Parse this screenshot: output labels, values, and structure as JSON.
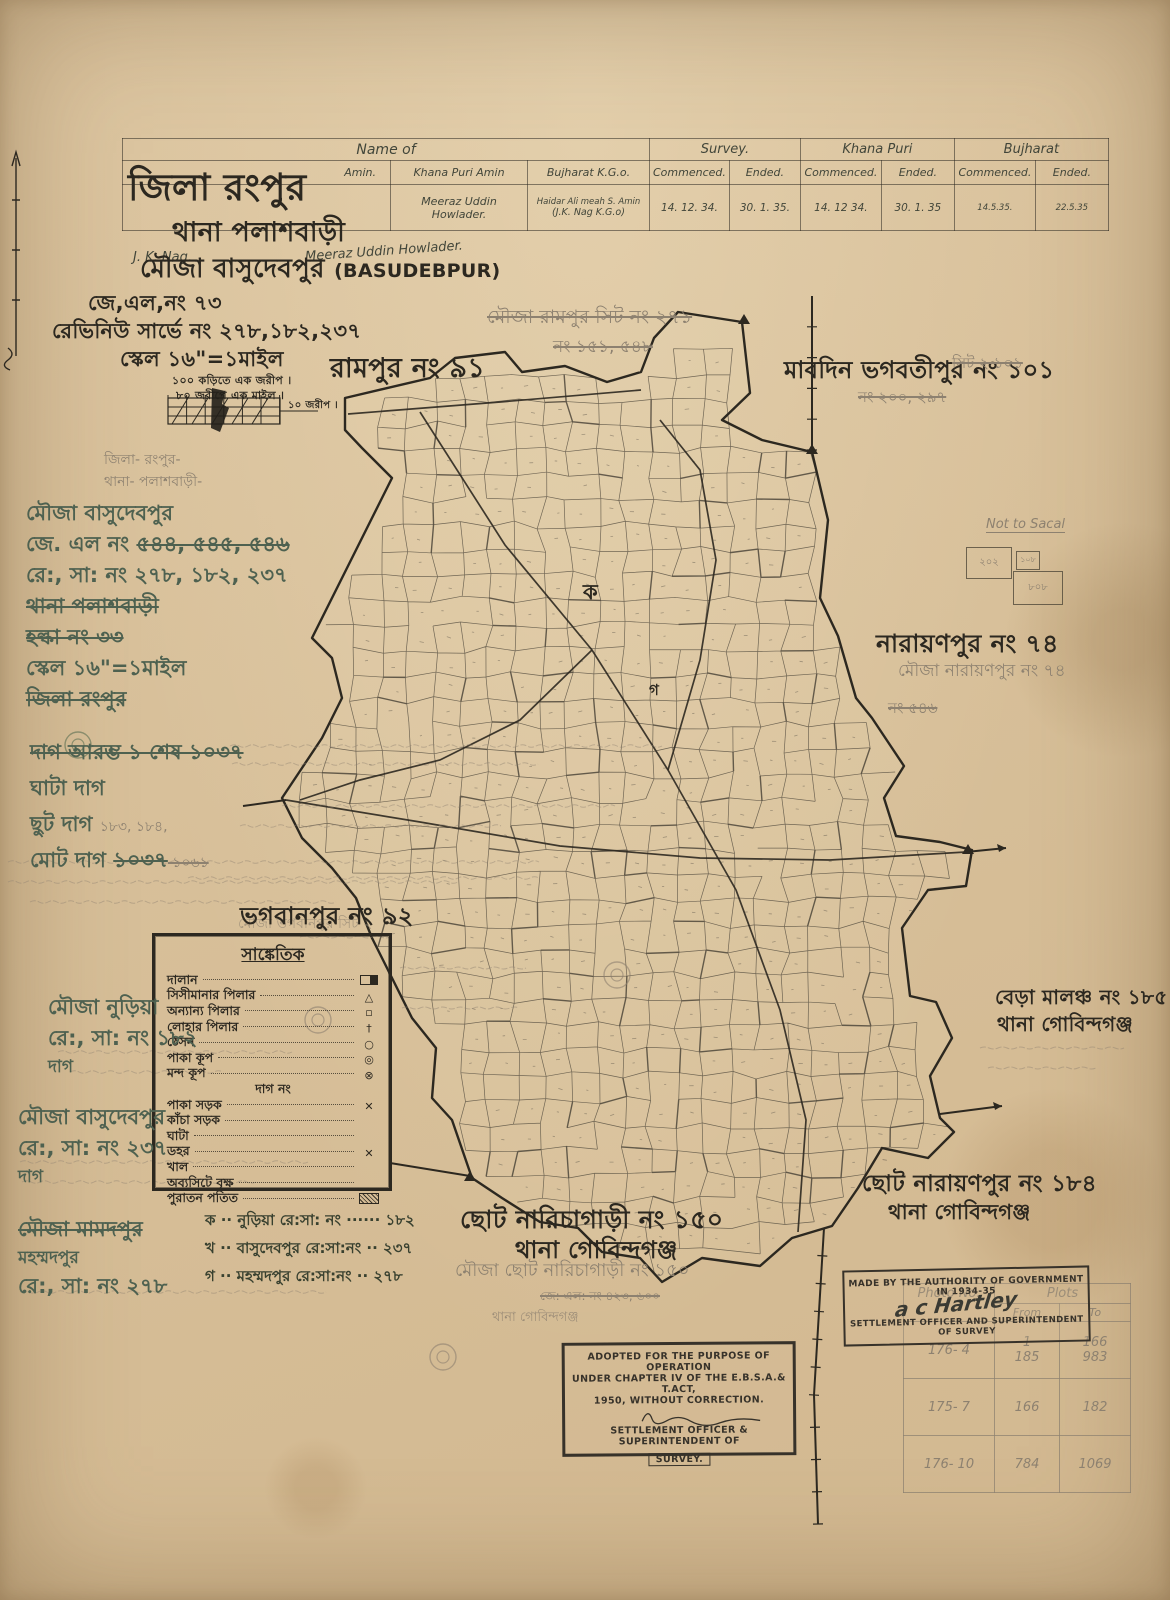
{
  "colors": {
    "paper": "#d8c09a",
    "ink": "#2c2820",
    "pencil": "#8d8170",
    "green": "#4e6150"
  },
  "title_block": {
    "district": "জিলা রংপুর",
    "thana": "থানা পলাশবাড়ী",
    "mouza": "মৌজা বাসুদেবপুর",
    "mouza_roman": "(BASUDEBPUR)",
    "jl_no": "জে,এল,নং ৭৩",
    "revenue_survey_no": "রেভিনিউ সার্ভে নং ২৭৮,১৮২,২৩৭",
    "scale": "স্কেল ১৬\"=১মাইল",
    "scale_note1": "১০০ কড়িতে এক জরীপ ।",
    "scale_note2": "৮০ জরীপে এক মাইল ।",
    "scale_bar_label": "১০ জরীপ ।"
  },
  "survey_table": {
    "name_of": "Name of",
    "amin": "Amin.",
    "khana_puri_amin": "Khana Puri Amin",
    "bujharat_kgo": "Bujharat K.G.o.",
    "survey": "Survey.",
    "khana_puri": "Khana Puri",
    "bujharat": "Bujharat",
    "commenced": "Commenced.",
    "ended": "Ended.",
    "row": {
      "jk_nag": "J. K. Nag.",
      "amin_name": "Meeraz Uddin Howlader.",
      "khana_puri_amin_name": "Meeraz Uddin Howlader.",
      "bujharat_1": "Haidar Ali meah  S. Amin",
      "bujharat_2": "(J.K. Nag  K.G.o)",
      "survey_c": "14. 12. 34.",
      "survey_e": "30. 1. 35.",
      "kp_c": "14. 12 34.",
      "kp_e": "30. 1. 35",
      "bj_c": "14.5.35.",
      "bj_e": "22.5.35"
    }
  },
  "neighbors": {
    "rampur": "রামপুর নং ৯১",
    "mabdin": "মাবদিন ভগবতীপুর নং ১০১",
    "narayanpur": "নারায়ণপুর নং ৭৪",
    "bhagabanpur": "ভগবানপুর নং ৯২",
    "bera_malancha_1": "বেড়া মালঞ্চ নং ১৮৫",
    "bera_malancha_2": "থানা গোবিন্দগঞ্জ",
    "chhoto_narayanpur_1": "ছোট নারায়ণপুর নং ১৮৪",
    "chhoto_narayanpur_2": "থানা গোবিন্দগঞ্জ",
    "chhoto_narichagari_1": "ছোট নারিচাগাড়ী নং ১৫০",
    "chhoto_narichagari_2": "থানা গোবিন্দগঞ্জ"
  },
  "zone_letters": {
    "ka": "ক",
    "ga": "গ"
  },
  "pencil_notes": {
    "rampur_sheet": "মৌজা রামপুর সিট নং ২৭১",
    "rampur_nos": "নং ১৫১, ৫৪৮",
    "sheet_101": "সিট ২ ১০১",
    "nos_200_297": "নং ২০০, ২৯৭",
    "mouza_narayanpur": "মৌজা নারায়ণপুর নং ৭৪",
    "no_546": "নং ৫৪৬",
    "bhagabanpur_sheet": "মৌজা ভগবানপুর সিট ২",
    "mouza_chhoto_narichagari": "মৌজা ছোট নারিচাগাড়ী নং ১৫০",
    "jl_note": "জে: এল: নং ৪২৩, ৬০০",
    "thana_gobindaganj": "থানা গোবিন্দগঞ্জ",
    "not_to_scale": "Not to Sacal",
    "sketch_nums": [
      "২০২",
      "১০৮",
      "৮০৮"
    ]
  },
  "legend": {
    "title": "সাঙ্কেতিক",
    "items": [
      {
        "label": "দালান",
        "symbol": "rect"
      },
      {
        "label": "সিসীমানার পিলার",
        "symbol": "triangle"
      },
      {
        "label": "অন্যান্য পিলার",
        "symbol": "square"
      },
      {
        "label": "লোহার পিলার",
        "symbol": "cross"
      },
      {
        "label": "ঠেসন",
        "symbol": "circle"
      },
      {
        "label": "পাকা কূপ",
        "symbol": "double-circle"
      },
      {
        "label": "মন্দ কূপ",
        "symbol": "circle-x"
      },
      {
        "label": "দাগ নং",
        "symbol": "none",
        "header": true
      },
      {
        "label": "পাকা সড়ক",
        "symbol": "road-x"
      },
      {
        "label": "কাঁচা সড়ক",
        "symbol": "none"
      },
      {
        "label": "ঘাটা",
        "symbol": "none"
      },
      {
        "label": "ডহর",
        "symbol": "road-x"
      },
      {
        "label": "খাল",
        "symbol": "none"
      },
      {
        "label": "অব্যসিটে বৃক্ষ",
        "symbol": "none"
      },
      {
        "label": "পুরাতন পতিত",
        "symbol": "rect-shaded"
      }
    ],
    "footnotes": [
      "ক ··  নুড়িয়া রে:সা: নং ······ ১৮২",
      "খ ··  বাসুদেবপুর রে:সা:নং ·· ২৩৭",
      "গ ··  মহম্মদপুর রে:সা:নং ·· ২৭৮"
    ]
  },
  "margin_blocks": {
    "b1": [
      [
        [
          "জিলা- রংপুর-",
          "p"
        ]
      ],
      [
        [
          "থানা- পলাশবাড়ী-",
          "p"
        ]
      ],
      [
        [
          "মৌজা বাসুদেবপুর",
          "g"
        ]
      ],
      [
        [
          "জে. এল নং ",
          "g"
        ],
        [
          "৫৪৪, ৫৪৫, ৫৪৬",
          "g s"
        ]
      ],
      [
        [
          "রে:, সা: নং ২৭৮, ১৮২, ২৩৭",
          "g"
        ]
      ],
      [
        [
          "থানা পলাশবাড়ী",
          "g s"
        ]
      ],
      [
        [
          "হল্কা নং ৩৩",
          "g s"
        ]
      ],
      [
        [
          "স্কেল ১৬\"=১মাইল",
          "g"
        ]
      ],
      [
        [
          "জিলা রংপুর",
          "g s"
        ]
      ]
    ],
    "b2": [
      [
        [
          "দাগ আরম্ভ ১   শেষ ১০৩৭",
          "g s"
        ]
      ],
      [
        [
          "ঘাটা দাগ",
          "g"
        ]
      ],
      [
        [
          "ছুট দাগ   ",
          "g"
        ],
        [
          "১৮৩, ১৮৪,",
          "p"
        ]
      ],
      [
        [
          "মোট দাগ ",
          "g"
        ],
        [
          "১০৩৭",
          "g s"
        ],
        [
          " ১০৬১",
          "p s"
        ]
      ]
    ],
    "b3": [
      [
        [
          "মৌজা নুড়িয়া",
          "g"
        ]
      ],
      [
        [
          "রে:, সা: নং ১৮২",
          "g"
        ]
      ],
      [
        [
          "দাগ",
          "gsm"
        ]
      ]
    ],
    "b4": [
      [
        [
          "মৌজা বাসুদেবপুর",
          "g"
        ]
      ],
      [
        [
          "রে:, সা: নং ২৩৭",
          "g"
        ]
      ],
      [
        [
          "দাগ",
          "gsm"
        ]
      ]
    ],
    "b5": [
      [
        [
          "মৌজা মামদপুর",
          "g s"
        ]
      ],
      [
        [
          "মহম্মদপুর",
          "gsm"
        ]
      ],
      [
        [
          "রে:, সা: নং ২৭৮",
          "g"
        ]
      ]
    ]
  },
  "stamps": {
    "made_by": "MADE BY THE AUTHORITY OF GOVERNMENT IN 1934-35",
    "made_by_officer": "SETTLEMENT OFFICER AND SUPERINTENDENT OF SURVEY",
    "signature": "a c Hartley",
    "adopted_lines": [
      "ADOPTED FOR THE PURPOSE OF OPERATION",
      "UNDER CHAPTER IV OF THE E.B.S.A.& T.ACT,",
      "1950, WITHOUT CORRECTION.",
      "SETTLEMENT OFFICER & SUPERINTENDENT OF",
      "SURVEY."
    ]
  },
  "photo_table": {
    "col_photo": "Photo No.",
    "col_plots": "Plots",
    "col_from": "From",
    "col_to": "To",
    "rows": [
      [
        "176- 4",
        "1|185",
        "166|983"
      ],
      [
        "175- 7",
        "166",
        "182"
      ],
      [
        "176- 10",
        "784",
        "1069"
      ]
    ]
  }
}
